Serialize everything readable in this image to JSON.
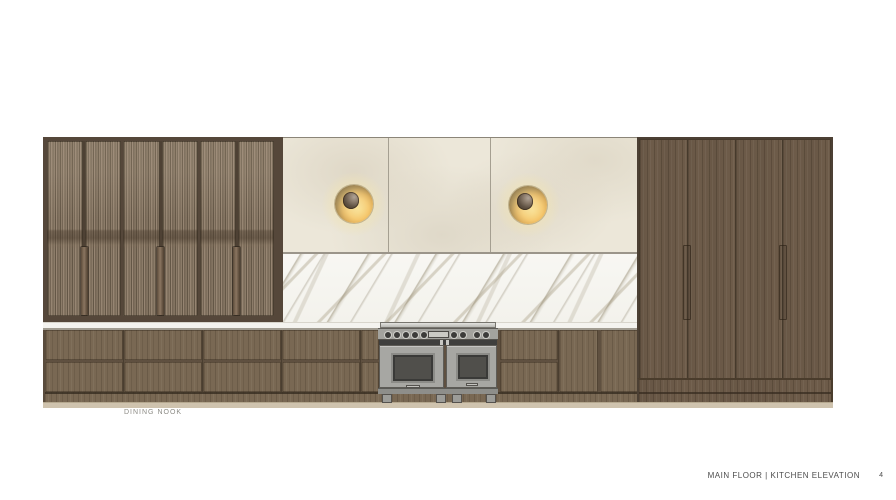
{
  "page": {
    "background_color": "#ffffff",
    "labels": {
      "dining_nook": "DINING NOOK"
    },
    "footer": {
      "title": "MAIN FLOOR | KITCHEN ELEVATION",
      "page_number": "4"
    }
  },
  "colors": {
    "wood-base": "#796853",
    "wood-tall": "#6d5b49",
    "wood-frame": "#55473a",
    "reeded-glass": "#8d7d6a",
    "handle-wood": "#77634e",
    "cream-panel": "#ece7d9",
    "panel-line": "#a59f91",
    "marble-base": "#f8f7f3",
    "marble-vein": "#a79c82",
    "counter": "#f4f3ef",
    "toe-kick": "#cfc3ae",
    "sconce-gold": "#efa93c",
    "sconce-dark": "#3c2b16",
    "range-body": "#a7a7a3",
    "range-panel": "#a3a39e",
    "range-dark": "#47474a",
    "text-footer": "#4c4c4c",
    "text-label": "#8c8b85"
  },
  "elevation": {
    "drawing_type": "kitchen-elevation",
    "left_cabinet": {
      "style": "reeded-glass-doors",
      "door_pairs": 3,
      "wood_pulls": 3
    },
    "upper_wall": {
      "panels": 3,
      "sconces": 2
    },
    "backsplash": {
      "style": "marble-slab"
    },
    "countertop": {
      "style": "white-stone"
    },
    "base_cabinets": {
      "drawer_bays": 6,
      "door_pair_bays": 1
    },
    "range": {
      "style": "pro-range",
      "knobs": 9,
      "oven_doors": 2,
      "feet": 4
    },
    "tall_cabinet": {
      "doors": 4,
      "recessed_pulls": 2
    }
  }
}
